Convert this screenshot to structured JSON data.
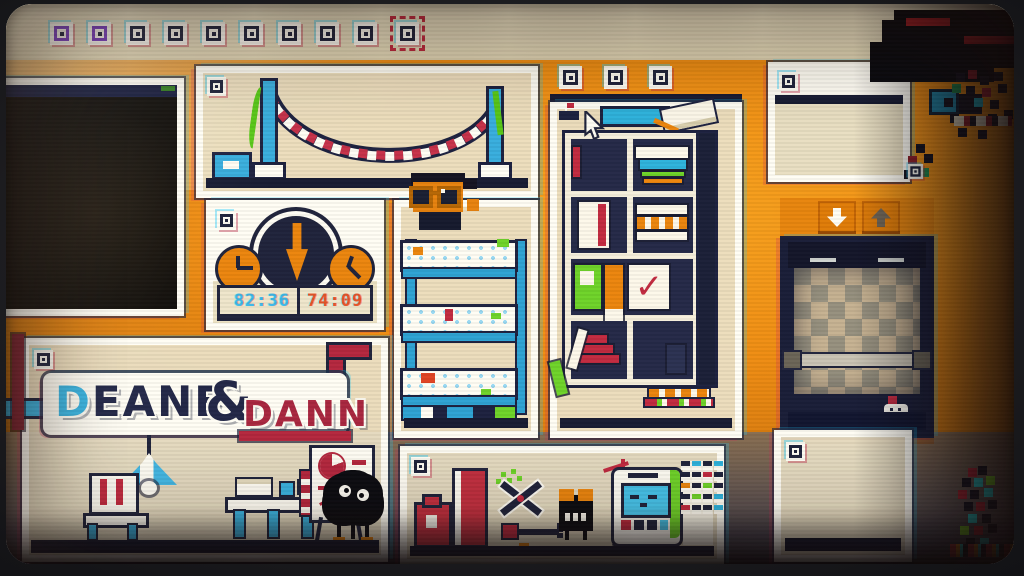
{
  "screen": {
    "kind": "crt-game-screen",
    "scene": "pixel-art rooms shown as draggable photo panels with glitch artifacts"
  },
  "colors": {
    "wall_orange": "#ef8d13",
    "band_beige": "#eae0c0",
    "panel_beige": "#ece2c3",
    "frame_white": "#fffdf4",
    "ink_navy": "#20243c",
    "accent_cyan": "#3ab2e0",
    "accent_red": "#c22b40",
    "accent_orange": "#ec860e",
    "accent_green": "#6fd32a",
    "digit_cyan": "#3db8e8",
    "digit_orange_red": "#e4562a",
    "elevator_header_orange": "#e8860e"
  },
  "filmstrip": {
    "frame_count": 10,
    "selected_index": 9
  },
  "clocks": {
    "time_left": "82:36",
    "time_right": "74:09"
  },
  "logo": {
    "deane": "DEANE",
    "amp": "&",
    "dann": "DANN"
  },
  "bookshelf": {
    "tab_count": 3
  },
  "elevator": {
    "buttons": [
      "down",
      "up"
    ]
  },
  "icons": {
    "window_control": "square-dot",
    "film_frame": "square-dot",
    "cursor": "arrow-cursor",
    "elevator_down": "chunky-down-arrow",
    "elevator_up": "chunky-up-arrow",
    "big_clock_pointer": "chunky-down-arrow",
    "checkmark_glyph": "✓"
  }
}
